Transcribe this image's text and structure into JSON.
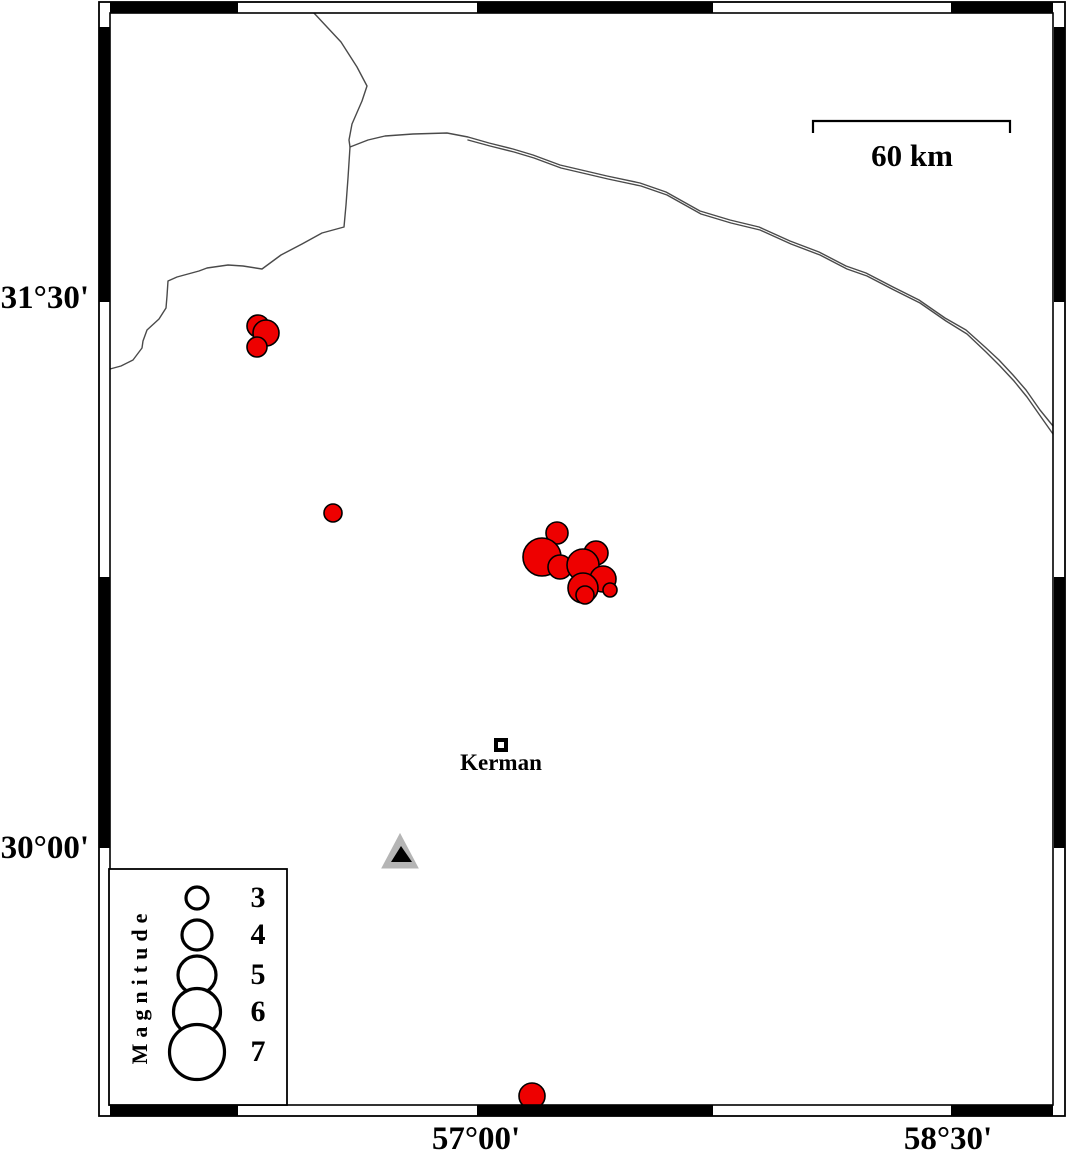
{
  "frame": {
    "axis_labels": {
      "left": [
        {
          "text": "31°30'"
        },
        {
          "text": "30°00'"
        }
      ],
      "bottom": [
        {
          "text": "57°00'"
        },
        {
          "text": "58°30'"
        }
      ]
    }
  },
  "scale_bar": {
    "label": "60 km",
    "x1": 813,
    "x2": 1010,
    "y": 121,
    "tick_drop": 12
  },
  "city": {
    "label": "Kerman",
    "x": 501,
    "y": 745
  },
  "station": {
    "x": 400,
    "y": 852
  },
  "legend": {
    "title": "Magnitude",
    "entries": [
      {
        "label": "3",
        "r": 11
      },
      {
        "label": "4",
        "r": 15
      },
      {
        "label": "5",
        "r": 19
      },
      {
        "label": "6",
        "r": 23.5
      },
      {
        "label": "7",
        "r": 27.5
      }
    ]
  },
  "map_data": {
    "earthquakes": [
      {
        "x": 258,
        "y": 326,
        "r": 11
      },
      {
        "x": 266,
        "y": 333,
        "r": 13
      },
      {
        "x": 257,
        "y": 347,
        "r": 10
      },
      {
        "x": 333,
        "y": 513,
        "r": 9
      },
      {
        "x": 557,
        "y": 533,
        "r": 11
      },
      {
        "x": 542,
        "y": 557,
        "r": 19
      },
      {
        "x": 560,
        "y": 567,
        "r": 12
      },
      {
        "x": 596,
        "y": 553,
        "r": 12
      },
      {
        "x": 583,
        "y": 565,
        "r": 16
      },
      {
        "x": 603,
        "y": 579,
        "r": 13
      },
      {
        "x": 583,
        "y": 588,
        "r": 15
      },
      {
        "x": 585,
        "y": 595,
        "r": 9
      },
      {
        "x": 610,
        "y": 590,
        "r": 7
      },
      {
        "x": 532,
        "y": 1096,
        "r": 13
      }
    ],
    "roads": [
      {
        "name": "border-road-west",
        "d": "M313,12 L341,42 L357,67 L367,86 L362,101 L352,124 L349,140 L350,147 L348,178 L346,205 L344,227 L322,233 L302,244 L281,255 L262,269 L243,266 L228,265 L207,268 L199,271 L188,274 L177,277 L168,281 L167,296 L166,308 L159,319 L147,330 L143,341 L142,348 L133,360 L121,366 L110,369"
      },
      {
        "name": "road-east-strand-1",
        "d": "M350,147 L368,140 L385,136 L413,134 L447,133 L468,137 L489,143 L513,149 L533,155 L560,165 L590,172 L607,176 L640,183 L666,192 L700,211 L730,220 L759,227 L790,241 L819,252 L846,266 L866,273 L893,287 L919,300 L945,318 L966,330 L985,347 L999,360 L1013,375 L1026,390 L1040,410 L1053,426"
      },
      {
        "name": "road-east-strand-2",
        "d": "M468,140 L490,146 L514,152 L534,158 L561,168 L591,175 L608,179 L641,186 L667,195 L701,214 L731,223 L760,230 L791,244 L820,255 L847,269 L867,276 L894,290 L920,303 L946,321 L967,334 L986,352 L1000,366 L1014,381 L1027,397 L1041,417 L1053,434"
      }
    ]
  },
  "colors": {
    "epicenter": "#ee0000",
    "outline": "#000000",
    "road": "#4a4a4a",
    "station_fill": "#b5b5b5",
    "frame": "#000000",
    "background": "#ffffff"
  }
}
